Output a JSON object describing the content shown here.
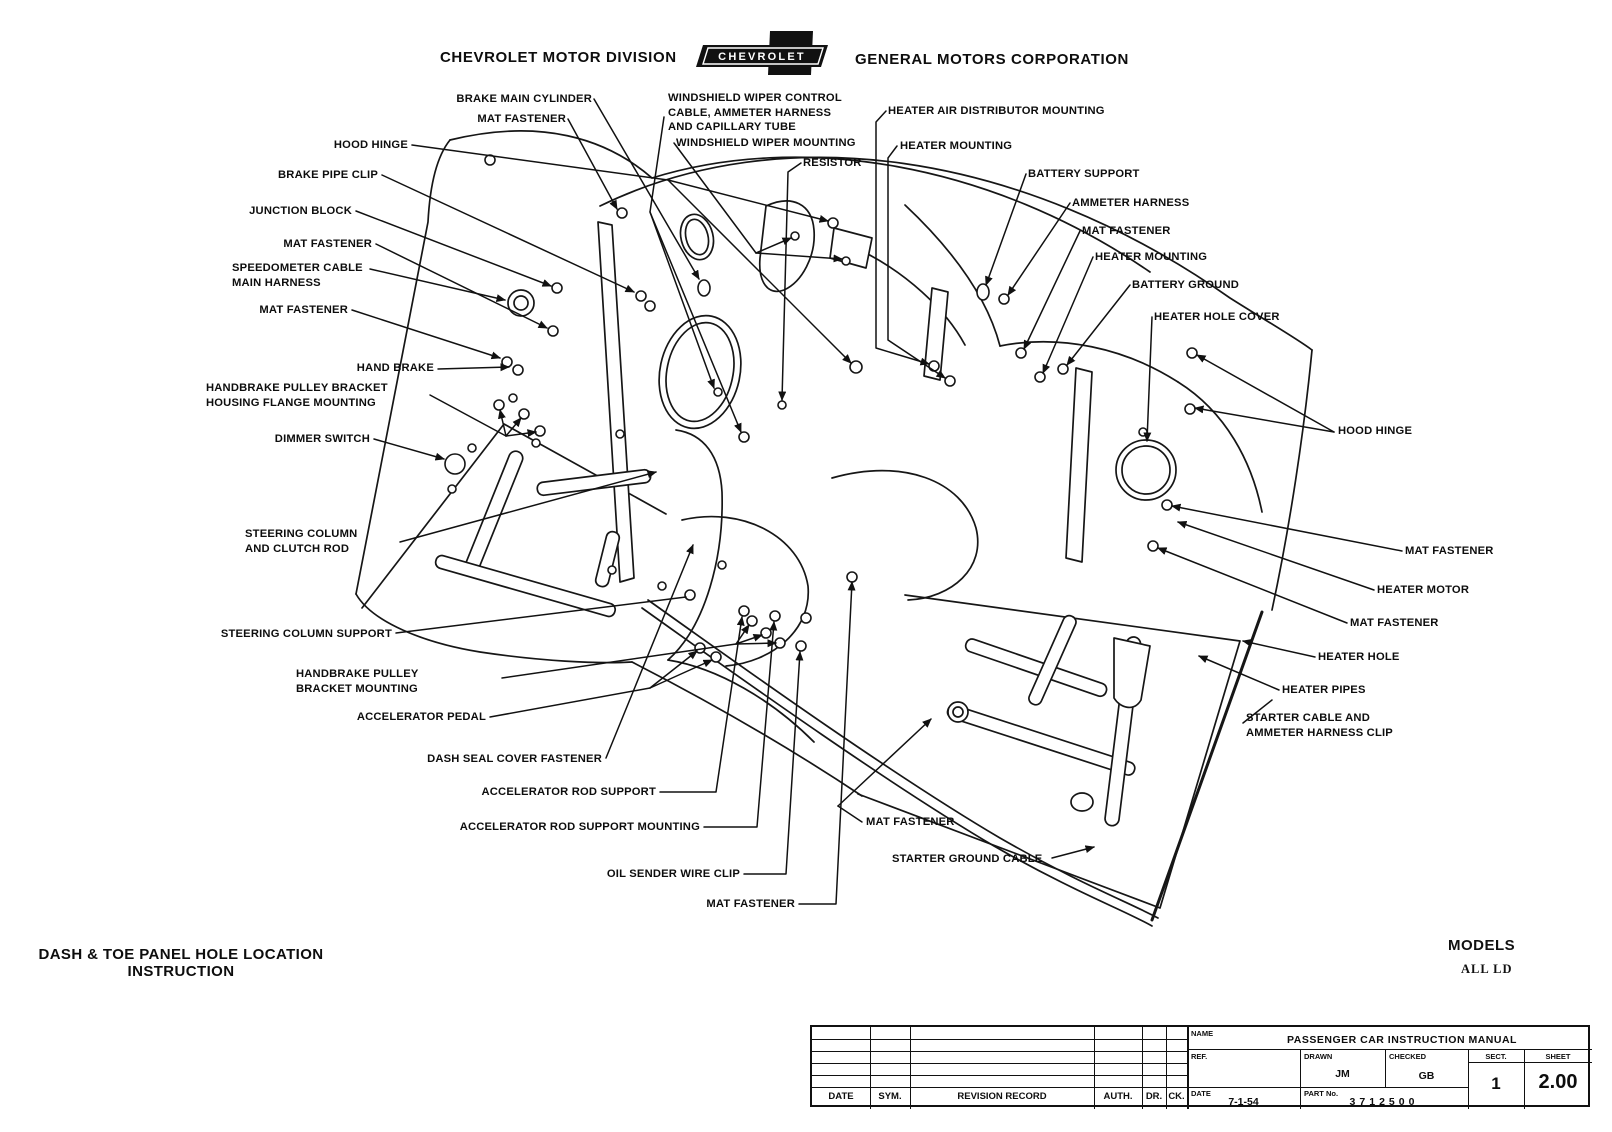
{
  "header": {
    "left": "CHEVROLET MOTOR DIVISION",
    "logo": "CHEVROLET",
    "right": "GENERAL MOTORS CORPORATION"
  },
  "callouts": [
    "BRAKE MAIN CYLINDER",
    "MAT FASTENER",
    "HOOD HINGE",
    "BRAKE PIPE CLIP",
    "JUNCTION BLOCK",
    "MAT FASTENER",
    "SPEEDOMETER CABLE\nMAIN HARNESS",
    "MAT FASTENER",
    "HAND BRAKE",
    "HANDBRAKE PULLEY BRACKET\nHOUSING FLANGE MOUNTING",
    "DIMMER SWITCH",
    "STEERING COLUMN\nAND CLUTCH ROD",
    "STEERING COLUMN SUPPORT",
    "HANDBRAKE PULLEY\nBRACKET MOUNTING",
    "ACCELERATOR PEDAL",
    "DASH SEAL COVER FASTENER",
    "ACCELERATOR ROD SUPPORT",
    "ACCELERATOR ROD SUPPORT MOUNTING",
    "OIL SENDER WIRE CLIP",
    "MAT FASTENER",
    "WINDSHIELD WIPER CONTROL\nCABLE, AMMETER HARNESS\nAND CAPILLARY TUBE",
    "WINDSHIELD WIPER MOUNTING",
    "RESISTOR",
    "HEATER AIR DISTRIBUTOR MOUNTING",
    "HEATER MOUNTING",
    "BATTERY SUPPORT",
    "AMMETER HARNESS",
    "MAT FASTENER",
    "HEATER MOUNTING",
    "BATTERY GROUND",
    "HEATER HOLE COVER",
    "HOOD HINGE",
    "MAT FASTENER",
    "HEATER MOTOR",
    "MAT FASTENER",
    "HEATER HOLE",
    "HEATER PIPES",
    "STARTER CABLE AND\nAMMETER HARNESS CLIP",
    "MAT FASTENER",
    "STARTER GROUND CABLE"
  ],
  "footer": {
    "title": "DASH & TOE PANEL HOLE LOCATION\nINSTRUCTION",
    "models_label": "MODELS",
    "models_value": "ALL LD"
  },
  "tb": {
    "rev": {
      "date": "DATE",
      "sym": "SYM.",
      "record": "REVISION RECORD",
      "auth": "AUTH.",
      "dr": "DR.",
      "ck": "CK."
    },
    "name_label": "NAME",
    "name": "PASSENGER CAR INSTRUCTION MANUAL",
    "ref_label": "REF.",
    "drawn_label": "DRAWN",
    "drawn": "JM",
    "checked_label": "CHECKED",
    "checked": "GB",
    "sect_label": "SECT.",
    "sect": "1",
    "sheet_label": "SHEET",
    "sheet": "2.00",
    "date_label": "DATE",
    "date": "7-1-54",
    "part_label": "PART No.",
    "part": "3712500"
  }
}
